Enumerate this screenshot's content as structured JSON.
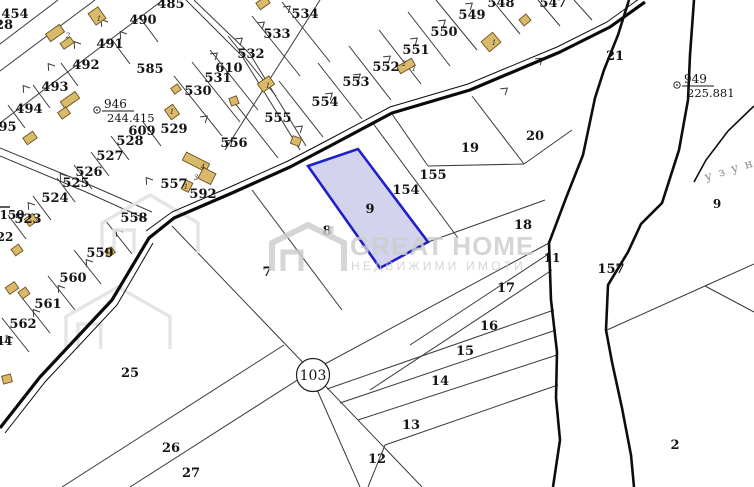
{
  "map": {
    "title": "cadastral-plan",
    "colors": {
      "line": "#3a3a3a",
      "road": "#0a0a0a",
      "river": "#0d0d0d",
      "selected_fill": "#aeaee0",
      "selected_stroke": "#2020c8",
      "building_fill": "#d9ba6b",
      "building_stroke": "#6e4f1e",
      "watermark": "#cdcdcd",
      "river_label_color": "#8a8a8a"
    },
    "watermark": {
      "brand": "GREAT HOME",
      "subtitle": "НЕДВИЖИМИ ИМОТИ"
    },
    "selected_parcel": "9",
    "circled_parcel": "103",
    "river_label": "узун",
    "benchmarks": [
      {
        "id": "946",
        "elevation": "244.415"
      },
      {
        "id": "949",
        "elevation": "225.881"
      }
    ],
    "parcel_labels": [
      {
        "n": "454",
        "x": 15,
        "y": 13
      },
      {
        "n": "28",
        "x": 4,
        "y": 24
      },
      {
        "n": "485",
        "x": 171,
        "y": 3
      },
      {
        "n": "490",
        "x": 143,
        "y": 19
      },
      {
        "n": "491",
        "x": 110,
        "y": 43
      },
      {
        "n": "492",
        "x": 86,
        "y": 64
      },
      {
        "n": "493",
        "x": 55,
        "y": 86
      },
      {
        "n": "494",
        "x": 29,
        "y": 108
      },
      {
        "n": "495",
        "x": 3,
        "y": 126
      },
      {
        "n": "585",
        "x": 150,
        "y": 68
      },
      {
        "n": "530",
        "x": 198,
        "y": 90
      },
      {
        "n": "531",
        "x": 218,
        "y": 77
      },
      {
        "n": "610",
        "x": 229,
        "y": 67
      },
      {
        "n": "532",
        "x": 251,
        "y": 53
      },
      {
        "n": "533",
        "x": 277,
        "y": 33
      },
      {
        "n": "534",
        "x": 305,
        "y": 13
      },
      {
        "n": "548",
        "x": 501,
        "y": 2
      },
      {
        "n": "547",
        "x": 553,
        "y": 2
      },
      {
        "n": "549",
        "x": 472,
        "y": 14
      },
      {
        "n": "550",
        "x": 444,
        "y": 31
      },
      {
        "n": "551",
        "x": 416,
        "y": 49
      },
      {
        "n": "552",
        "x": 386,
        "y": 66
      },
      {
        "n": "553",
        "x": 356,
        "y": 81
      },
      {
        "n": "554",
        "x": 325,
        "y": 101
      },
      {
        "n": "555",
        "x": 278,
        "y": 117
      },
      {
        "n": "556",
        "x": 234,
        "y": 142
      },
      {
        "n": "557",
        "x": 174,
        "y": 183
      },
      {
        "n": "592",
        "x": 203,
        "y": 193
      },
      {
        "n": "558",
        "x": 134,
        "y": 217
      },
      {
        "n": "559",
        "x": 100,
        "y": 252
      },
      {
        "n": "560",
        "x": 73,
        "y": 277
      },
      {
        "n": "561",
        "x": 48,
        "y": 303
      },
      {
        "n": "562",
        "x": 23,
        "y": 323
      },
      {
        "n": "524",
        "x": 55,
        "y": 197
      },
      {
        "n": "523",
        "x": 28,
        "y": 218
      },
      {
        "n": "525",
        "x": 76,
        "y": 182
      },
      {
        "n": "526",
        "x": 89,
        "y": 171
      },
      {
        "n": "527",
        "x": 110,
        "y": 155
      },
      {
        "n": "528",
        "x": 130,
        "y": 140
      },
      {
        "n": "609",
        "x": 142,
        "y": 130
      },
      {
        "n": "529",
        "x": 174,
        "y": 128
      },
      {
        "n": "150",
        "x": 12,
        "y": 214,
        "size": 12
      },
      {
        "n": "22",
        "x": 5,
        "y": 236,
        "size": 12
      },
      {
        "n": "44",
        "x": 4,
        "y": 340,
        "size": 12
      },
      {
        "n": "25",
        "x": 130,
        "y": 372
      },
      {
        "n": "26",
        "x": 171,
        "y": 447
      },
      {
        "n": "27",
        "x": 191,
        "y": 472
      },
      {
        "n": "7",
        "x": 267,
        "y": 271
      },
      {
        "n": "8",
        "x": 327,
        "y": 230
      },
      {
        "n": "9",
        "x": 370,
        "y": 208
      },
      {
        "n": "154",
        "x": 406,
        "y": 189
      },
      {
        "n": "155",
        "x": 433,
        "y": 174
      },
      {
        "n": "19",
        "x": 470,
        "y": 147
      },
      {
        "n": "20",
        "x": 535,
        "y": 135
      },
      {
        "n": "18",
        "x": 523,
        "y": 224
      },
      {
        "n": "17",
        "x": 506,
        "y": 287
      },
      {
        "n": "16",
        "x": 489,
        "y": 325
      },
      {
        "n": "15",
        "x": 465,
        "y": 350
      },
      {
        "n": "14",
        "x": 440,
        "y": 380
      },
      {
        "n": "13",
        "x": 411,
        "y": 424
      },
      {
        "n": "12",
        "x": 377,
        "y": 458
      },
      {
        "n": "11",
        "x": 552,
        "y": 257,
        "size": 12
      },
      {
        "n": "21",
        "x": 615,
        "y": 55
      },
      {
        "n": "157",
        "x": 611,
        "y": 268
      },
      {
        "n": "2",
        "x": 675,
        "y": 444
      },
      {
        "n": "9",
        "x": 717,
        "y": 203,
        "size": 12
      }
    ],
    "building_labels": [
      {
        "t": "1",
        "x": 99,
        "y": 21
      },
      {
        "t": "2",
        "x": 68,
        "y": 38
      },
      {
        "t": "1",
        "x": 172,
        "y": 114
      },
      {
        "t": "4",
        "x": 203,
        "y": 169
      },
      {
        "t": "3",
        "x": 196,
        "y": 180
      },
      {
        "t": "1",
        "x": 186,
        "y": 189
      },
      {
        "t": "1",
        "x": 494,
        "y": 45
      },
      {
        "t": "2",
        "x": 404,
        "y": 66
      },
      {
        "t": "1",
        "x": 414,
        "y": 71
      },
      {
        "t": "1",
        "x": 268,
        "y": 88
      }
    ]
  }
}
